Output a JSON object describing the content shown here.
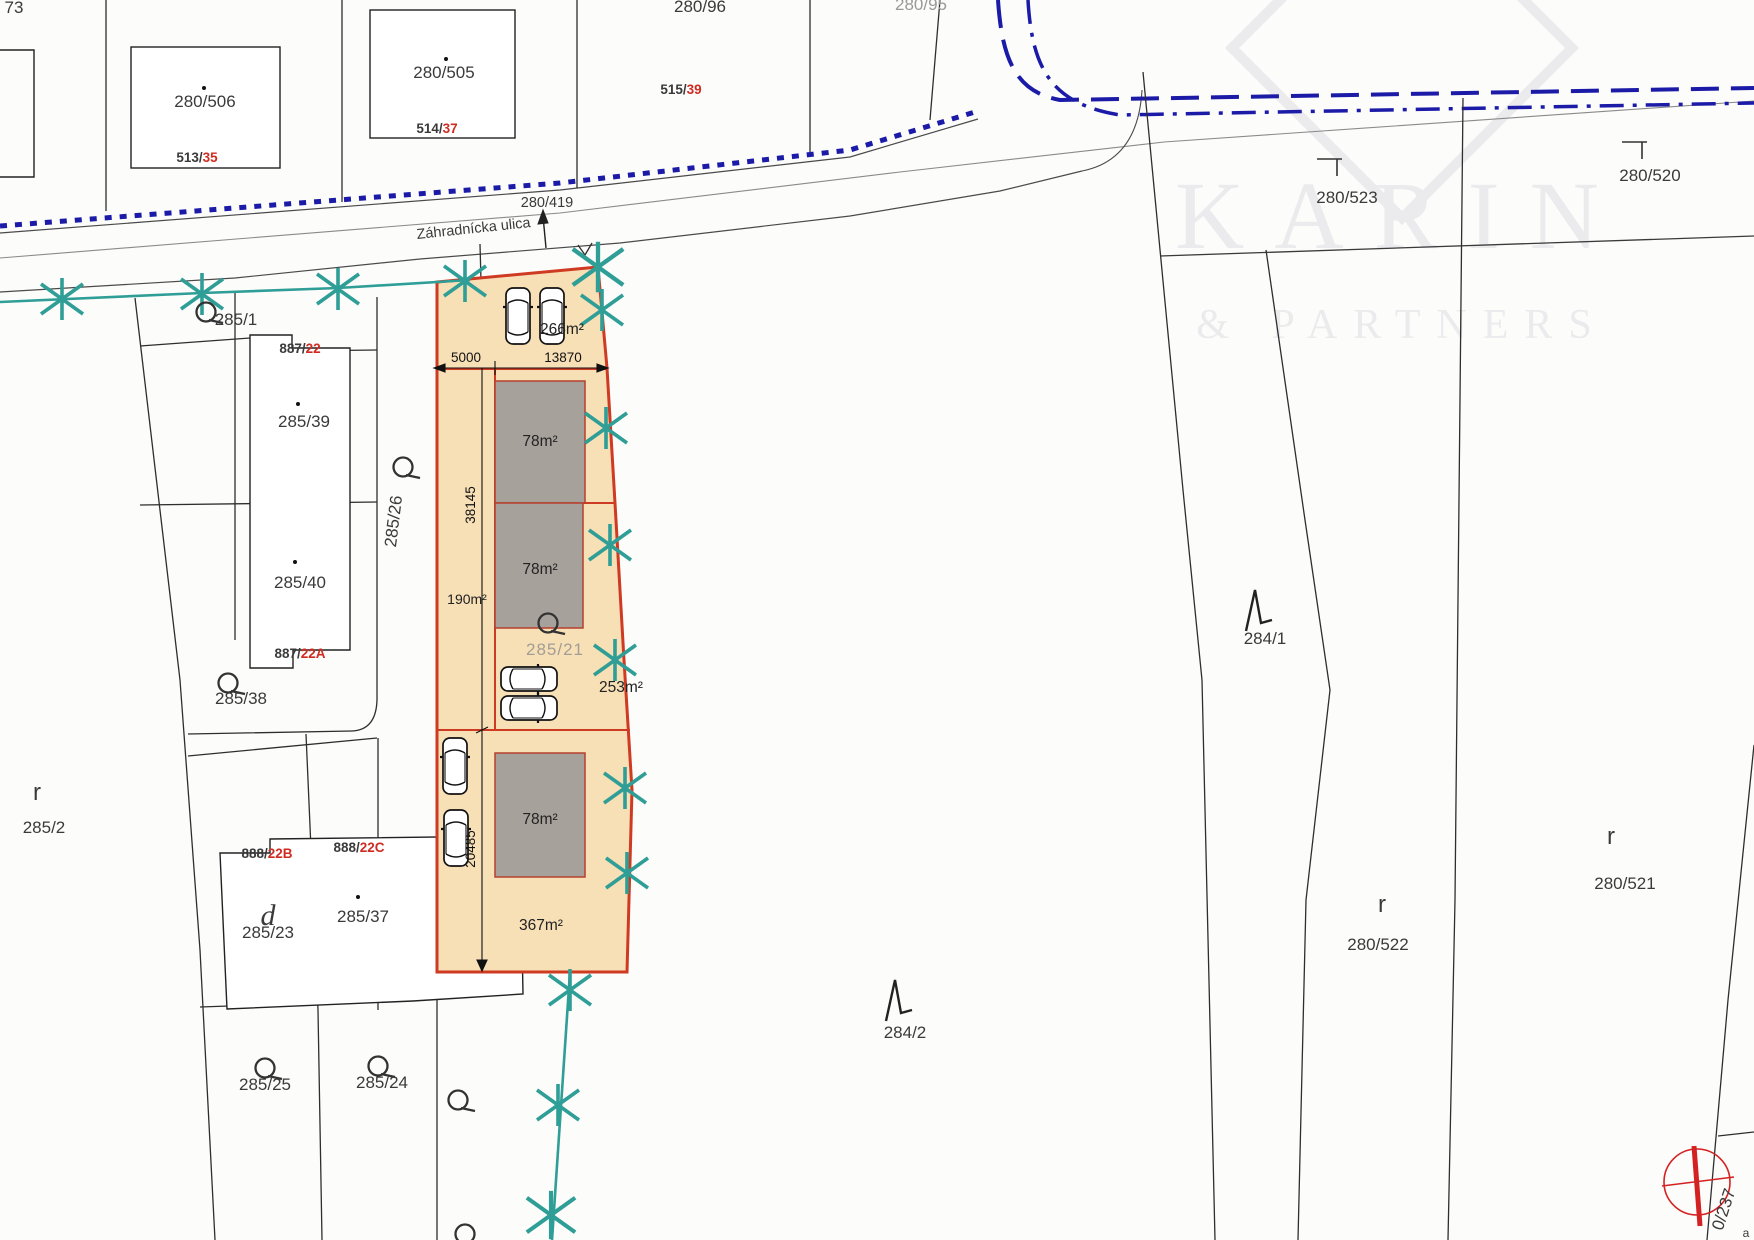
{
  "title": "Cadastral site plan with highlighted parcel",
  "street": {
    "name": "Záhradnícka ulica",
    "road_parcel": "280/419"
  },
  "watermark": {
    "line1": "KARIN",
    "line2": "& PARTNERS"
  },
  "labels": {
    "b73": "73",
    "p280_506": "280/506",
    "bl513": "513/",
    "bl513r": "35",
    "p280_505": "280/505",
    "bl514": "514/",
    "bl514r": "37",
    "bl515": "515/",
    "bl515r": "39",
    "p280_96": "280/96",
    "p280_95": "280/95",
    "p280_419": "280/419",
    "street": "Záhradnícka ulica",
    "p280_523": "280/523",
    "p280_520": "280/520",
    "p285_1": "285/1",
    "bl887": "887/",
    "bl887r": "22",
    "p285_39": "285/39",
    "p285_26": "285/26",
    "p285_40": "285/40",
    "bl887a": "887/",
    "bl887ar": "22A",
    "p285_38": "285/38",
    "p285_2": "285/2",
    "r": "r",
    "bl888b": "888/",
    "bl888br": "22B",
    "bl888c": "888/",
    "bl888cr": "22C",
    "d": "d",
    "p285_23": "285/23",
    "p285_37": "285/37",
    "p285_25": "285/25",
    "p285_24": "285/24",
    "p285_21": "285/21",
    "p284_1": "284/1",
    "p284_2": "284/2",
    "p280_522": "280/522",
    "p280_521": "280/521",
    "rot237": "0/237",
    "a": "a"
  },
  "highlight_parcel": {
    "areas": {
      "a266": "266m²",
      "a78_1": "78m²",
      "a78_2": "78m²",
      "a190": "190m²",
      "a253": "253m²",
      "a78_3": "78m²",
      "a367": "367m²"
    },
    "dimensions": {
      "d5000": "5000",
      "d13870": "13870",
      "d38145": "38145",
      "d20485": "20485"
    },
    "gray_parcel_number": "285/21",
    "cars": 6,
    "tree_marks": 14
  },
  "colors": {
    "hl-fill": "#f7dfb6",
    "hl-stroke": "#cf3a22",
    "bld-fill": "#a7a19b",
    "bld-stroke": "#b5402e",
    "teal": "#2f9e96",
    "blue": "#1b1ba8",
    "red-label": "#cf2b20",
    "ink": "#3a3a3a",
    "faint": "#ebebee",
    "gray-label": "#a39d96",
    "compass": "#d42222"
  }
}
